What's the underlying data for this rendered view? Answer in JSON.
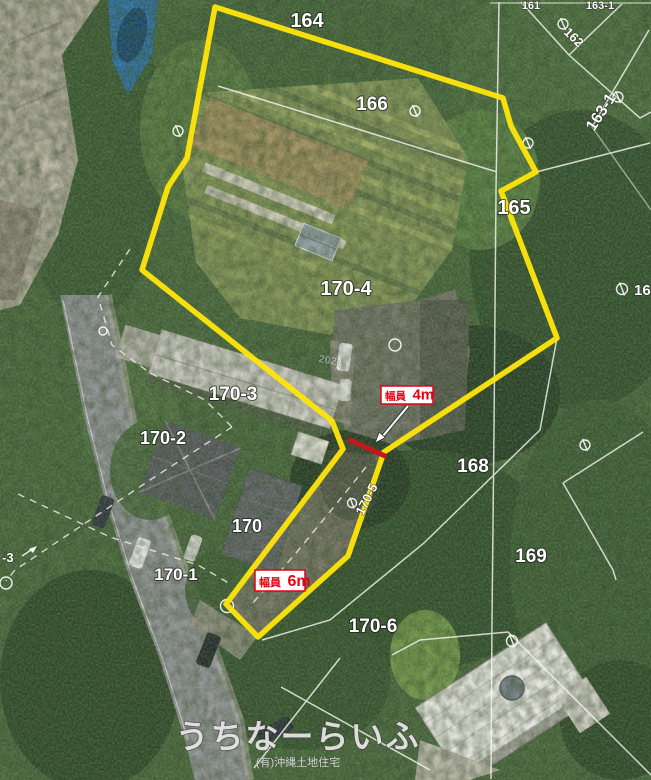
{
  "map": {
    "parcel_labels": {
      "p161": "161",
      "p162": "162",
      "p163_1_top": "163-1",
      "p163_1_side": "163-1",
      "p164": "164",
      "p165": "165",
      "p166": "166",
      "p168": "168",
      "p169": "169",
      "p170": "170",
      "p170_1": "170-1",
      "p170_2": "170-2",
      "p170_3": "170-3",
      "p170_4": "170-4",
      "p170_5": "170-5",
      "p170_6": "170-6",
      "p_edge_left": "-3",
      "p_edge_right": "16"
    },
    "annotations": {
      "width_4m": {
        "prefix": "幅員",
        "value": "4m"
      },
      "width_6m": {
        "prefix": "幅員",
        "value": "6m"
      }
    },
    "faint_roof_text": "2021",
    "watermark": {
      "brand": "うちなーらいふ",
      "company": "(有)沖縄土地住宅"
    },
    "colors": {
      "boundary": "#ffe60a",
      "annotation_red": "#e60012",
      "cadastral_line": "#f8f8f3"
    }
  }
}
